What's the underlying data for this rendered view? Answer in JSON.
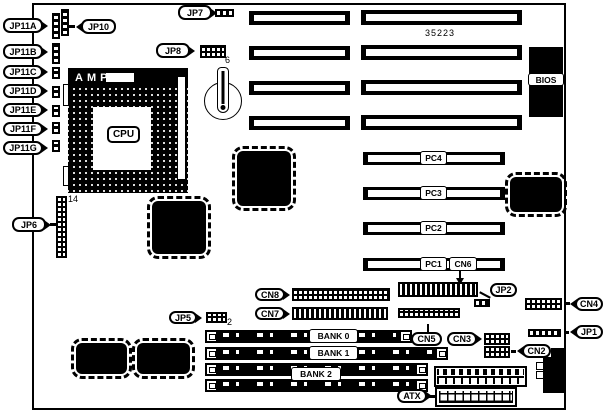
{
  "diagram": {
    "part_number": "35223",
    "cpu": {
      "socket_brand": "AMP",
      "label": "CPU"
    },
    "bios": "BIOS",
    "callouts": {
      "jp11a": "JP11A",
      "jp11b": "JP11B",
      "jp11c": "JP11C",
      "jp11d": "JP11D",
      "jp11e": "JP11E",
      "jp11f": "JP11F",
      "jp11g": "JP11G",
      "jp10": "JP10",
      "jp7": "JP7",
      "jp8": "JP8",
      "jp6": "JP6",
      "jp5": "JP5",
      "jp2": "JP2",
      "jp1": "JP1",
      "cn2": "CN2",
      "cn3": "CN3",
      "cn4": "CN4",
      "cn5": "CN5",
      "cn6": "CN6",
      "cn7": "CN7",
      "cn8": "CN8",
      "atx": "ATX"
    },
    "pci_slots": [
      "PC4",
      "PC3",
      "PC2",
      "PC1"
    ],
    "memory_banks": [
      "BANK 0",
      "BANK 1",
      "BANK 2"
    ],
    "pin_markers": {
      "jp8": "6",
      "jp5": "2",
      "jp6": "14"
    }
  }
}
